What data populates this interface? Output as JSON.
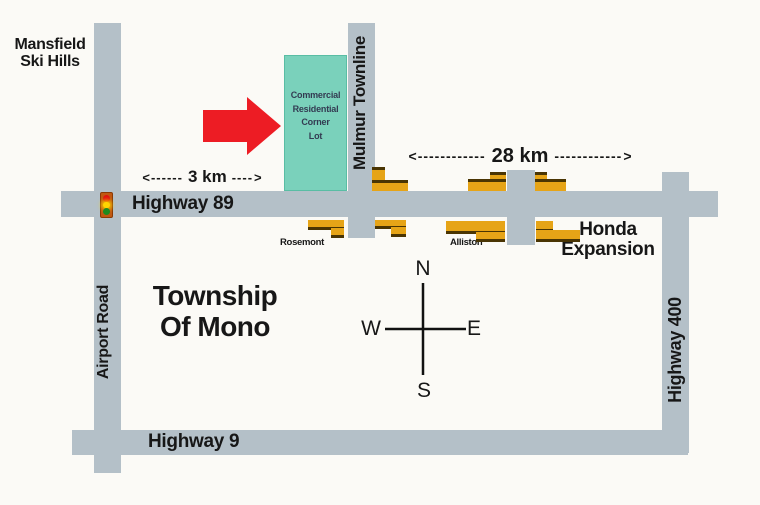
{
  "colors": {
    "bg": "#fbfaf6",
    "road": "#b4c0c8",
    "teal": "#7ad1bb",
    "teal_border": "#59bda4",
    "gold": "#e6a417",
    "brown": "#4a3503",
    "red": "#ed1c24",
    "ink": "#171717",
    "lot_ink": "#333b52"
  },
  "labels": {
    "mansfield": [
      "Mansfield",
      "Ski Hills"
    ],
    "lot": [
      "Commercial",
      "Residential",
      "Corner",
      "Lot"
    ],
    "mulmur": "Mulmur Townline",
    "airport_road": "Airport Road",
    "highway89": "Highway 89",
    "highway9": "Highway 9",
    "highway400": "Highway 400",
    "township": [
      "Township",
      "Of Mono"
    ],
    "honda": [
      "Honda",
      "Expansion"
    ],
    "rosemont": "Rosemont",
    "alliston": "Alliston"
  },
  "compass": {
    "north": "N",
    "south": "S",
    "east": "E",
    "west": "W"
  },
  "distance_markers": {
    "km3": {
      "open": "<",
      "left_dashes": "------",
      "label": "3 km",
      "right_dashes": "----",
      "close": ">"
    },
    "km28": {
      "open": "<",
      "left_dashes": "------------",
      "label": "28 km",
      "right_dashes": "------------",
      "close": ">"
    }
  },
  "buildings": [
    {
      "name": "north-1",
      "parts": [
        [
          372,
          167,
          13,
          16,
          "top"
        ],
        [
          372,
          180,
          36,
          11,
          "top"
        ]
      ]
    },
    {
      "name": "north-2",
      "parts": [
        [
          490,
          172,
          16,
          8,
          "top"
        ],
        [
          468,
          179,
          38,
          12,
          "top"
        ]
      ]
    },
    {
      "name": "north-3",
      "parts": [
        [
          535,
          172,
          12,
          8,
          "top"
        ],
        [
          535,
          179,
          31,
          12,
          "top"
        ]
      ]
    },
    {
      "name": "rosemont",
      "parts": [
        [
          308,
          220,
          36,
          10,
          "bottom"
        ],
        [
          331,
          228,
          13,
          10,
          "bottom"
        ]
      ]
    },
    {
      "name": "south-2",
      "parts": [
        [
          375,
          220,
          31,
          9,
          "bottom"
        ],
        [
          391,
          227,
          15,
          10,
          "bottom"
        ]
      ]
    },
    {
      "name": "alliston",
      "parts": [
        [
          446,
          221,
          59,
          13,
          "bottom"
        ],
        [
          476,
          232,
          29,
          10,
          "bottom"
        ]
      ]
    },
    {
      "name": "honda",
      "parts": [
        [
          536,
          221,
          17,
          11,
          "bottom"
        ],
        [
          536,
          230,
          44,
          12,
          "bottom"
        ]
      ]
    }
  ]
}
